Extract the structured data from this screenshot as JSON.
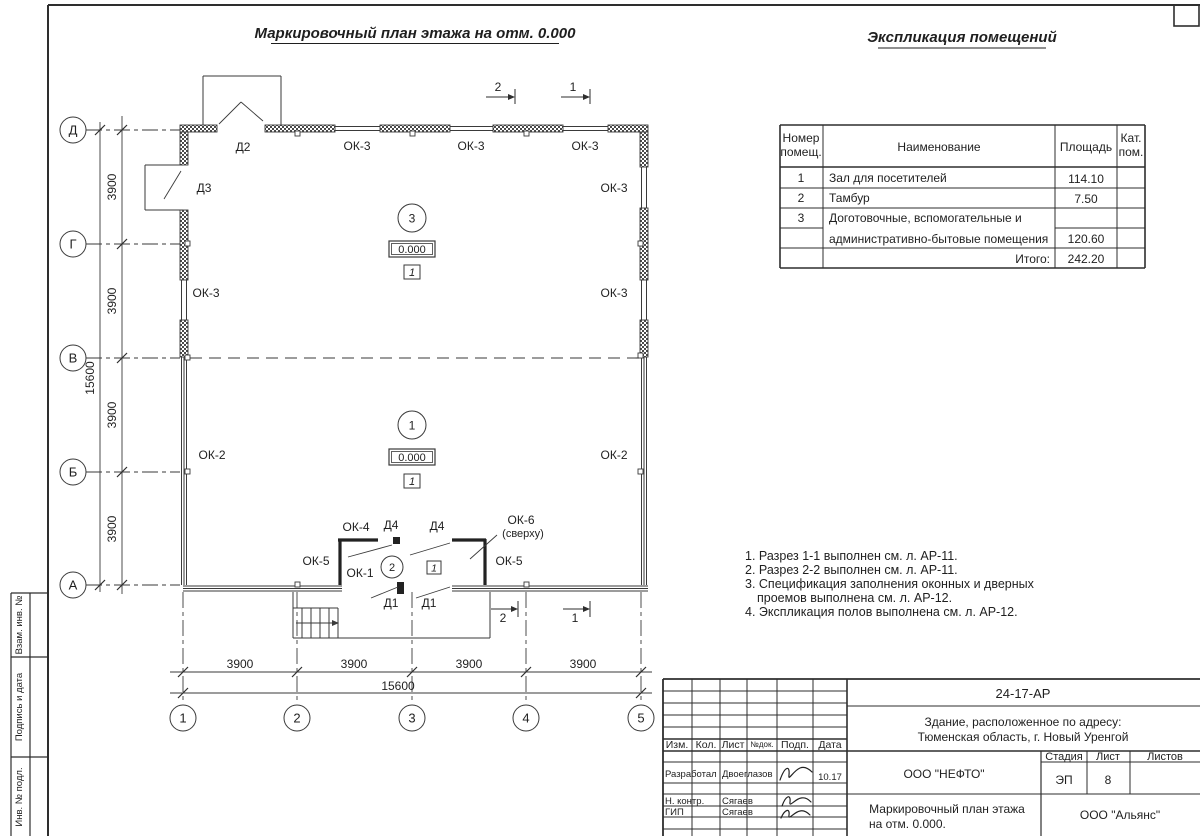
{
  "page": {
    "plan_title": "Маркировочный план этажа на отм. 0.000",
    "explication_title": "Экспликация помещений"
  },
  "explication": {
    "header": {
      "num1": "Номер",
      "num2": "помещ.",
      "name": "Наименование",
      "area": "Площадь",
      "cat1": "Кат.",
      "cat2": "пом."
    },
    "rows": [
      {
        "num": "1",
        "name": "Зал для посетителей",
        "area": "114.10"
      },
      {
        "num": "2",
        "name": "Тамбур",
        "area": "7.50"
      },
      {
        "num": "3",
        "name": "Доготовочные, вспомогательные и",
        "area": ""
      },
      {
        "num": "",
        "name": "административно-бытовые помещения",
        "area": "120.60"
      },
      {
        "num": "",
        "name": "Итого:",
        "area": "242.20"
      }
    ]
  },
  "notes": {
    "lines": [
      "1. Разрез 1-1 выполнен см. л. АР-11.",
      "2. Разрез 2-2 выполнен см. л. АР-11.",
      "3. Спецификация заполнения оконных и дверных",
      "проемов выполнена см. л. АР-12.",
      "4. Экспликация полов выполнена см. л. АР-12."
    ]
  },
  "plan": {
    "axes_letters": [
      "Д",
      "Г",
      "В",
      "Б",
      "А"
    ],
    "axes_numbers": [
      "1",
      "2",
      "3",
      "4",
      "5"
    ],
    "dims": {
      "seg": "3900",
      "total": "15600"
    },
    "labels": {
      "d1": "Д1",
      "d2": "Д2",
      "d3": "Д3",
      "d4": "Д4",
      "ok1": "ОК-1",
      "ok2": "ОК-2",
      "ok3": "ОК-3",
      "ok4": "ОК-4",
      "ok5": "ОК-5",
      "ok6": "ОК-6",
      "ok6_note": "(сверху)"
    },
    "rooms": {
      "r1": "1",
      "r2": "2",
      "r3": "3"
    },
    "elevation": "0.000",
    "floor_type": "1",
    "sections": {
      "s1": "1",
      "s2": "2"
    }
  },
  "title_block": {
    "doc_number": "24-17-АР",
    "object_line1": "Здание, расположенное по адресу:",
    "object_line2": "Тюменская область, г. Новый Уренгой",
    "company": "ООО \"НЕФТО\"",
    "drawing_line1": "Маркировочный план этажа",
    "drawing_line2": "на отм. 0.000.",
    "org": "ООО \"Альянс\"",
    "cols": {
      "izm": "Изм.",
      "kol": "Кол.",
      "list": "Лист",
      "ndoc": "№док.",
      "podp": "Подп.",
      "data": "Дата"
    },
    "stage_label": "Стадия",
    "sheet_label": "Лист",
    "sheets_label": "Листов",
    "stage": "ЭП",
    "sheet": "8",
    "rows": {
      "r1_role": "Разработал",
      "r1_name": "Двоеглазов",
      "r1_date": "10.17",
      "r2_role": "Н. контр.",
      "r2_name": "Сягаев",
      "r3_role": "ГИП",
      "r3_name": "Сягаев"
    }
  },
  "side_stamp": {
    "box1": "Взам. инв. №",
    "box2": "Подпись и дата",
    "box3": "Инв. № подл."
  }
}
